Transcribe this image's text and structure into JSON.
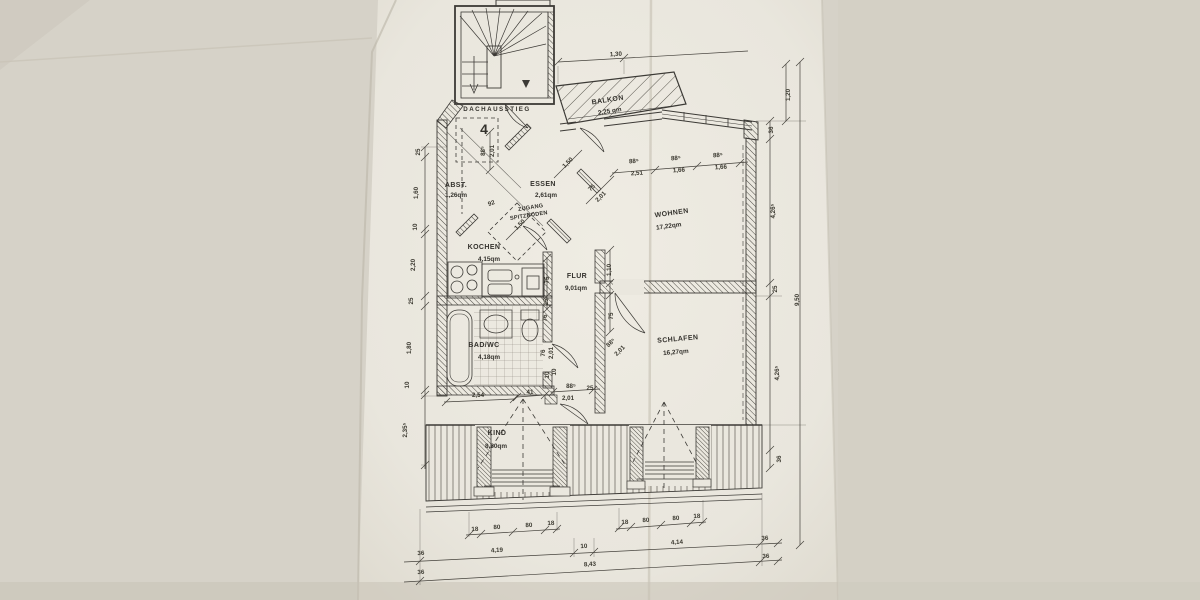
{
  "document": {
    "kind": "scanned architectural floor plan photo",
    "language": "de"
  },
  "colors": {
    "paper": "#eae7de",
    "margin": "#d6d2c8",
    "ink": "#3c3a36"
  },
  "plan": {
    "stair_label": "DACHAUSSTIEG",
    "unit_number": "4",
    "loft_access": {
      "line1": "ZUGANG",
      "line2": "SPITZBODEN"
    },
    "rooms": {
      "balkon": {
        "name": "BALKON",
        "area": "2,25 qm"
      },
      "abst": {
        "name": "ABST.",
        "area": "1,26qm"
      },
      "essen": {
        "name": "ESSEN",
        "area": "2,61qm"
      },
      "wohnen": {
        "name": "WOHNEN",
        "area": "17,22qm"
      },
      "kochen": {
        "name": "KOCHEN",
        "area": "4,15qm"
      },
      "flur": {
        "name": "FLUR",
        "area": "9,01qm"
      },
      "bad": {
        "name": "BAD/WC",
        "area": "4,18qm"
      },
      "schlafen": {
        "name": "SCHLAFEN",
        "area": "16,27qm"
      },
      "kind": {
        "name": "KIND",
        "area": "8,60qm"
      }
    }
  },
  "dims": {
    "top_width": "1,30",
    "windows": {
      "heights": [
        "88⁵",
        "88⁵",
        "88⁵"
      ],
      "widths": [
        "2,51",
        "1,66",
        "1,66"
      ]
    },
    "left": [
      "25",
      "1,60",
      "10",
      "2,20",
      "25",
      "1,80",
      "10",
      "2,35⁵"
    ],
    "right": [
      "36",
      "4,26⁵",
      "25",
      "4,26⁵",
      "36"
    ],
    "balcony_depth": "1,20",
    "total_height": "9,50",
    "dormer_left": [
      "18",
      "80",
      "80",
      "18"
    ],
    "dormer_right": [
      "18",
      "80",
      "80",
      "18"
    ],
    "bottom_segments": [
      "36",
      "4,19",
      "10",
      "4,14",
      "36"
    ],
    "bottom_total": [
      "36",
      "8,43",
      "36"
    ],
    "interior": {
      "stair_door_w": "88⁵",
      "stair_door_h": "2,01",
      "d92": "92",
      "d150a": "1,50",
      "d150b": "1,50",
      "essen_door_w": "75",
      "essen_door_h": "2,01",
      "flur_w": "75",
      "flur_n": "25",
      "wohnen_n": "1,10",
      "wohnen_s": "75",
      "bad_n": "76",
      "bad_door_w": "76",
      "bad_door_h": "2,01",
      "bad_s": "10",
      "schlafen_door_w": "88⁵",
      "schlafen_door_h": "2,01",
      "kind_door_w": "88⁵",
      "kind_door_h": "2,01",
      "kind_n": "25",
      "kind_s": "10",
      "d254": "2,54",
      "d41": "41"
    }
  }
}
